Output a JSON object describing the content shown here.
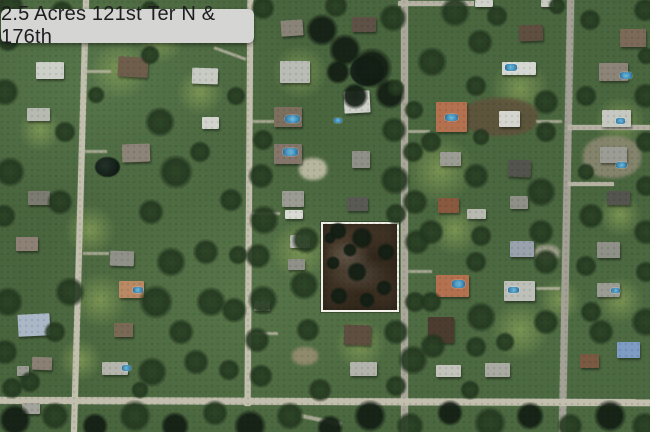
{
  "title": {
    "label": "2.5 Acres 121st Ter N & 176th",
    "bg": "#d5d5d4",
    "text_color": "#1d1d1f"
  },
  "map": {
    "format": {
      "tree": "[x,y,radius,dark?]",
      "lawn": "[x,y,radius]",
      "pond": "[x,y,w,h]",
      "dirt": "[x,y,w,h,color]",
      "driveway": "[x,y,w,h,rotation]",
      "house": "[x,y,w,h,roof_color,rotation]",
      "pool": "[x,y,w,h]"
    },
    "palette": {
      "road": "#c3bfae",
      "road_paved": "#a3a196",
      "pool": "#4f9cc4",
      "ground": "#49653e"
    },
    "parcel": {
      "x": 321,
      "y": 222,
      "w": 78,
      "h": 90,
      "border": "#f1f0e9",
      "fill": "#483a2a",
      "trees": [
        [
          338,
          231,
          9
        ],
        [
          362,
          238,
          11
        ],
        [
          386,
          252,
          9
        ],
        [
          333,
          263,
          7
        ],
        [
          357,
          272,
          10
        ],
        [
          384,
          288,
          8
        ],
        [
          339,
          296,
          9
        ],
        [
          367,
          300,
          8
        ],
        [
          350,
          250,
          7
        ],
        [
          330,
          238,
          6
        ]
      ]
    },
    "roads": [
      {
        "x": 77,
        "y": -5,
        "w": 6,
        "h": 442,
        "rot": 1.6
      },
      {
        "x": 246,
        "y": -4,
        "w": 6,
        "h": 410,
        "rot": 0.4
      },
      {
        "x": 401,
        "y": -4,
        "w": 7,
        "h": 440,
        "rot": 0,
        "c": "#aaa79a"
      },
      {
        "x": 563,
        "y": -5,
        "w": 7,
        "h": 442,
        "rot": 1.1,
        "c": "#a3a196"
      },
      {
        "x": -5,
        "y": 398,
        "w": 660,
        "h": 7,
        "rot": 0.2
      },
      {
        "x": 398,
        "y": 1,
        "w": 76,
        "h": 5,
        "rot": 0,
        "c": "#b5b2a4"
      },
      {
        "x": 568,
        "y": 125,
        "w": 82,
        "h": 5,
        "rot": 0,
        "c": "#b5b2a4"
      },
      {
        "x": 568,
        "y": 182,
        "w": 46,
        "h": 4,
        "rot": 0,
        "c": "#b5b2a4"
      }
    ],
    "driveways": [
      [
        83,
        70,
        28,
        3,
        0
      ],
      [
        83,
        150,
        24,
        3,
        0
      ],
      [
        83,
        252,
        26,
        3,
        0
      ],
      [
        213,
        52,
        34,
        3,
        20
      ],
      [
        252,
        120,
        26,
        3,
        0
      ],
      [
        252,
        212,
        28,
        3,
        0
      ],
      [
        252,
        332,
        26,
        3,
        0
      ],
      [
        408,
        270,
        24,
        3,
        0
      ],
      [
        408,
        130,
        22,
        3,
        0
      ],
      [
        536,
        120,
        26,
        3,
        0
      ],
      [
        536,
        287,
        24,
        3,
        0
      ],
      [
        300,
        418,
        42,
        4,
        12
      ]
    ],
    "ponds": [
      [
        95,
        157,
        25,
        20
      ],
      [
        350,
        56,
        34,
        30
      ]
    ],
    "dirt": [
      [
        583,
        136,
        58,
        42,
        "#8f8a74"
      ],
      [
        462,
        98,
        76,
        38,
        "#60523c"
      ],
      [
        299,
        158,
        28,
        22,
        "#c9c4ae"
      ],
      [
        534,
        245,
        26,
        16,
        "#a9a694"
      ],
      [
        292,
        347,
        26,
        18,
        "#9a8f74"
      ]
    ],
    "lawns": [
      [
        120,
        70,
        30
      ],
      [
        300,
        72,
        28
      ],
      [
        90,
        230,
        26
      ],
      [
        300,
        250,
        30
      ],
      [
        440,
        170,
        35
      ],
      [
        520,
        88,
        30
      ],
      [
        620,
        122,
        26
      ],
      [
        100,
        300,
        28
      ],
      [
        360,
        345,
        26
      ],
      [
        520,
        330,
        30
      ],
      [
        620,
        300,
        24
      ],
      [
        40,
        130,
        22
      ],
      [
        200,
        92,
        24
      ],
      [
        455,
        230,
        26
      ],
      [
        560,
        300,
        22
      ],
      [
        160,
        40,
        24
      ],
      [
        620,
        215,
        22
      ],
      [
        80,
        360,
        22
      ]
    ],
    "houses": [
      [
        36,
        62,
        28,
        17,
        "#cdd0c9",
        0
      ],
      [
        118,
        57,
        30,
        20,
        "#6f5e4c",
        3
      ],
      [
        27,
        108,
        23,
        13,
        "#b6bab1",
        0
      ],
      [
        122,
        144,
        28,
        18,
        "#8d8478",
        -2
      ],
      [
        28,
        191,
        22,
        14,
        "#7b7b72",
        0
      ],
      [
        192,
        68,
        26,
        16,
        "#c8cbc3",
        2
      ],
      [
        202,
        117,
        17,
        12,
        "#d2d4cd",
        0
      ],
      [
        16,
        237,
        22,
        14,
        "#8d8175",
        0
      ],
      [
        110,
        251,
        24,
        15,
        "#90928a",
        2
      ],
      [
        119,
        281,
        25,
        17,
        "#b98a64",
        0
      ],
      [
        18,
        314,
        32,
        22,
        "#a9b7c6",
        -3
      ],
      [
        114,
        323,
        19,
        14,
        "#7a6a55",
        0
      ],
      [
        102,
        362,
        26,
        13,
        "#b4b6ae",
        0
      ],
      [
        32,
        357,
        20,
        13,
        "#8a8174",
        2
      ],
      [
        17,
        366,
        12,
        10,
        "#9a9b93",
        0
      ],
      [
        22,
        403,
        18,
        11,
        "#a2a39a",
        0
      ],
      [
        281,
        20,
        22,
        16,
        "#8a8378",
        -4
      ],
      [
        352,
        17,
        24,
        15,
        "#5e5146",
        0
      ],
      [
        280,
        61,
        30,
        22,
        "#b9bcb5",
        0
      ],
      [
        274,
        107,
        28,
        20,
        "#7c6f5e",
        0
      ],
      [
        274,
        144,
        28,
        20,
        "#84766a",
        0
      ],
      [
        344,
        91,
        26,
        22,
        "#cfd2cb",
        -3
      ],
      [
        352,
        151,
        18,
        17,
        "#8f9188",
        0
      ],
      [
        282,
        191,
        22,
        16,
        "#9a9c93",
        0
      ],
      [
        285,
        210,
        18,
        9,
        "#d8dad3",
        0
      ],
      [
        347,
        197,
        21,
        14,
        "#5a5a54",
        0
      ],
      [
        290,
        235,
        20,
        13,
        "#b5b8b0",
        0
      ],
      [
        288,
        259,
        17,
        11,
        "#8f9188",
        0
      ],
      [
        254,
        301,
        16,
        10,
        "#b0b2aa",
        0
      ],
      [
        344,
        325,
        27,
        20,
        "#5f4f40",
        2
      ],
      [
        350,
        362,
        27,
        14,
        "#b2b4ac",
        0
      ],
      [
        475,
        0,
        18,
        7,
        "#d0d3cc",
        0
      ],
      [
        541,
        0,
        13,
        7,
        "#c8cbc4",
        0
      ],
      [
        519,
        25,
        24,
        16,
        "#5f4f41",
        -2
      ],
      [
        502,
        62,
        34,
        13,
        "#d6d9d2",
        0
      ],
      [
        436,
        102,
        31,
        30,
        "#b4714f",
        0
      ],
      [
        499,
        111,
        21,
        16,
        "#d4d6cf",
        0
      ],
      [
        440,
        152,
        21,
        14,
        "#9b9d94",
        0
      ],
      [
        508,
        160,
        23,
        17,
        "#54544e",
        3
      ],
      [
        438,
        198,
        21,
        15,
        "#8a5a40",
        0
      ],
      [
        467,
        209,
        19,
        10,
        "#b8bab2",
        0
      ],
      [
        510,
        196,
        18,
        13,
        "#8f9188",
        0
      ],
      [
        510,
        241,
        24,
        16,
        "#9aa3ad",
        0
      ],
      [
        436,
        275,
        33,
        22,
        "#b4714f",
        0
      ],
      [
        504,
        281,
        31,
        20,
        "#bdc0b9",
        0
      ],
      [
        428,
        317,
        26,
        26,
        "#4c3c30",
        0
      ],
      [
        436,
        365,
        25,
        12,
        "#c2c4bc",
        0
      ],
      [
        485,
        363,
        25,
        14,
        "#a9aba3",
        0
      ],
      [
        620,
        29,
        26,
        18,
        "#7c6a58",
        0
      ],
      [
        599,
        63,
        29,
        18,
        "#8d8478",
        0
      ],
      [
        602,
        110,
        29,
        17,
        "#c6c9c1",
        0
      ],
      [
        600,
        147,
        27,
        16,
        "#9b9d94",
        0
      ],
      [
        607,
        191,
        23,
        14,
        "#55554f",
        0
      ],
      [
        597,
        242,
        23,
        16,
        "#8f9188",
        0
      ],
      [
        597,
        283,
        23,
        14,
        "#9b9d94",
        0
      ],
      [
        580,
        354,
        19,
        14,
        "#7a5a42",
        0
      ],
      [
        617,
        342,
        23,
        16,
        "#7e9cc4",
        0
      ]
    ],
    "pools": [
      [
        285,
        115,
        15,
        8
      ],
      [
        283,
        148,
        15,
        8
      ],
      [
        505,
        64,
        12,
        7
      ],
      [
        445,
        114,
        13,
        7
      ],
      [
        452,
        280,
        13,
        8
      ],
      [
        508,
        287,
        11,
        6
      ],
      [
        620,
        72,
        12,
        7
      ],
      [
        616,
        118,
        9,
        6
      ],
      [
        616,
        162,
        11,
        6
      ],
      [
        611,
        288,
        9,
        5
      ],
      [
        133,
        287,
        10,
        6
      ],
      [
        122,
        365,
        9,
        6
      ],
      [
        334,
        118,
        8,
        5
      ]
    ],
    "trees": [
      [
        10,
        6,
        14
      ],
      [
        62,
        12,
        12
      ],
      [
        150,
        10,
        10
      ],
      [
        263,
        8,
        12
      ],
      [
        322,
        30,
        16,
        1
      ],
      [
        336,
        6,
        12
      ],
      [
        393,
        18,
        14
      ],
      [
        455,
        12,
        15
      ],
      [
        497,
        16,
        11
      ],
      [
        557,
        6,
        9
      ],
      [
        645,
        10,
        12
      ],
      [
        345,
        50,
        16,
        1
      ],
      [
        372,
        68,
        20,
        1
      ],
      [
        390,
        94,
        15,
        1
      ],
      [
        355,
        96,
        13,
        1
      ],
      [
        338,
        72,
        12,
        1
      ],
      [
        263,
        140,
        11
      ],
      [
        261,
        176,
        13
      ],
      [
        264,
        220,
        15
      ],
      [
        258,
        256,
        13
      ],
      [
        263,
        300,
        15
      ],
      [
        257,
        340,
        13
      ],
      [
        261,
        376,
        12
      ],
      [
        236,
        96,
        10
      ],
      [
        231,
        200,
        12
      ],
      [
        234,
        310,
        13
      ],
      [
        229,
        370,
        11
      ],
      [
        238,
        255,
        10
      ],
      [
        394,
        130,
        13
      ],
      [
        413,
        152,
        11
      ],
      [
        395,
        180,
        15
      ],
      [
        415,
        202,
        13
      ],
      [
        396,
        214,
        11
      ],
      [
        417,
        242,
        13
      ],
      [
        415,
        302,
        11
      ],
      [
        396,
        332,
        13
      ],
      [
        413,
        360,
        15
      ],
      [
        396,
        386,
        11
      ],
      [
        414,
        110,
        10
      ],
      [
        396,
        88,
        9
      ],
      [
        306,
        240,
        14
      ],
      [
        304,
        285,
        15
      ],
      [
        308,
        330,
        12
      ],
      [
        8,
        40,
        12
      ],
      [
        5,
        92,
        14
      ],
      [
        10,
        172,
        15
      ],
      [
        4,
        216,
        12
      ],
      [
        8,
        302,
        15
      ],
      [
        5,
        352,
        13
      ],
      [
        12,
        388,
        11
      ],
      [
        160,
        122,
        15
      ],
      [
        176,
        172,
        17
      ],
      [
        151,
        212,
        13
      ],
      [
        171,
        262,
        15
      ],
      [
        156,
        302,
        17
      ],
      [
        181,
        332,
        13
      ],
      [
        152,
        372,
        15
      ],
      [
        200,
        152,
        11
      ],
      [
        206,
        252,
        13
      ],
      [
        211,
        302,
        15
      ],
      [
        196,
        362,
        13
      ],
      [
        65,
        132,
        11
      ],
      [
        60,
        202,
        13
      ],
      [
        70,
        292,
        15
      ],
      [
        55,
        332,
        11
      ],
      [
        150,
        55,
        10
      ],
      [
        96,
        95,
        9
      ],
      [
        480,
        42,
        13
      ],
      [
        432,
        62,
        15
      ],
      [
        476,
        86,
        11
      ],
      [
        546,
        102,
        13
      ],
      [
        431,
        142,
        11
      ],
      [
        481,
        137,
        9
      ],
      [
        546,
        132,
        11
      ],
      [
        476,
        176,
        13
      ],
      [
        541,
        192,
        15
      ],
      [
        431,
        232,
        13
      ],
      [
        481,
        236,
        11
      ],
      [
        541,
        232,
        13
      ],
      [
        476,
        262,
        11
      ],
      [
        546,
        262,
        13
      ],
      [
        431,
        302,
        11
      ],
      [
        481,
        317,
        15
      ],
      [
        546,
        322,
        13
      ],
      [
        476,
        347,
        11
      ],
      [
        433,
        346,
        13
      ],
      [
        505,
        342,
        10
      ],
      [
        590,
        20,
        11
      ],
      [
        646,
        56,
        9
      ],
      [
        586,
        96,
        11
      ],
      [
        646,
        96,
        13
      ],
      [
        586,
        172,
        9
      ],
      [
        646,
        142,
        11
      ],
      [
        591,
        216,
        13
      ],
      [
        646,
        186,
        11
      ],
      [
        586,
        266,
        11
      ],
      [
        646,
        232,
        13
      ],
      [
        591,
        312,
        11
      ],
      [
        646,
        272,
        11
      ],
      [
        601,
        332,
        13
      ],
      [
        646,
        322,
        15
      ],
      [
        15,
        420,
        16,
        1
      ],
      [
        55,
        416,
        14
      ],
      [
        95,
        426,
        13,
        1
      ],
      [
        135,
        416,
        16
      ],
      [
        175,
        426,
        14,
        1
      ],
      [
        215,
        413,
        13
      ],
      [
        250,
        426,
        16,
        1
      ],
      [
        290,
        416,
        14
      ],
      [
        330,
        428,
        13,
        1
      ],
      [
        370,
        416,
        16,
        1
      ],
      [
        410,
        426,
        14
      ],
      [
        450,
        413,
        13,
        1
      ],
      [
        490,
        423,
        16
      ],
      [
        530,
        416,
        14,
        1
      ],
      [
        570,
        426,
        13
      ],
      [
        610,
        416,
        16,
        1
      ],
      [
        645,
        426,
        14
      ],
      [
        30,
        382,
        11
      ],
      [
        140,
        390,
        9
      ],
      [
        320,
        390,
        12
      ],
      [
        470,
        390,
        10
      ]
    ]
  }
}
